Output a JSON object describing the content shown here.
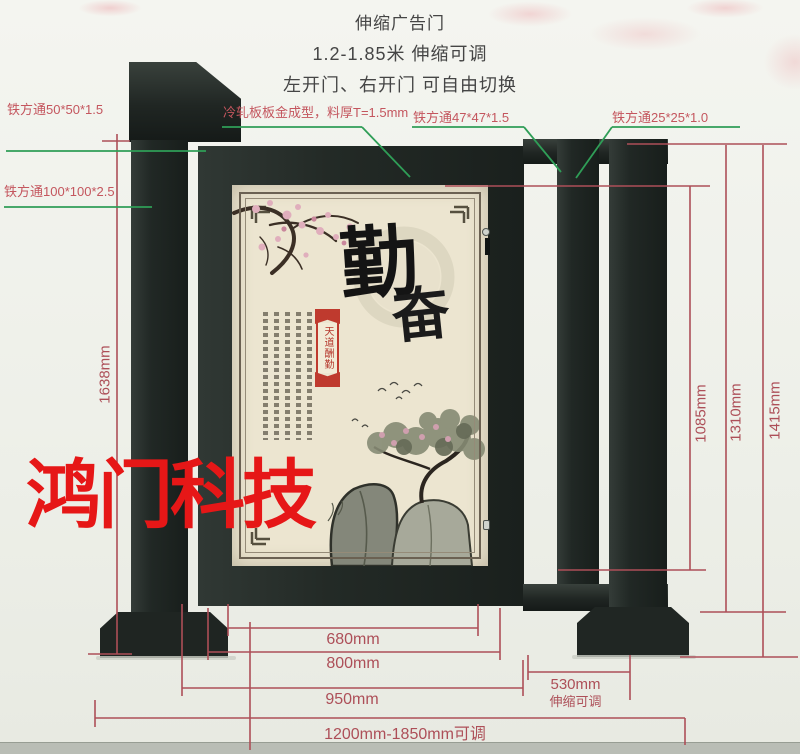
{
  "header": {
    "title": "伸缩广告门",
    "subtitle": "1.2-1.85米 伸缩可调",
    "note": "左开门、右开门 可自由切换"
  },
  "part_labels": {
    "tube50": "铁方通50*50*1.5",
    "tube100": "铁方通100*100*2.5",
    "cold_rolled_panel": "冷轧板板金成型，料厚T=1.5mm",
    "tube47": "铁方通47*47*1.5",
    "tube25": "铁方通25*25*1.0"
  },
  "dimensions": {
    "left_post_height": "1638mm",
    "inner_height": "1085mm",
    "frame_height": "1310mm",
    "total_height": "1415mm",
    "panel_width": "680mm",
    "door_width": "800mm",
    "gate_width": "950mm",
    "telescopic_width": "530mm",
    "telescopic_note": "伸缩可调",
    "total_width_range": "1200mm-1850mm可调"
  },
  "poster": {
    "calligraphy_char_1": "勤",
    "calligraphy_char_2": "奋",
    "seal_text": "天道酬勤"
  },
  "watermark": "鸿门科技",
  "colors": {
    "steel": "#232a26",
    "dimension_line": "#ad4f58",
    "leader_line": "#2f9e57",
    "label_red": "#c4565e",
    "poster_paper": "#ece5d0",
    "watermark_red": "#e61717",
    "seal_red": "#bf3a2e"
  }
}
